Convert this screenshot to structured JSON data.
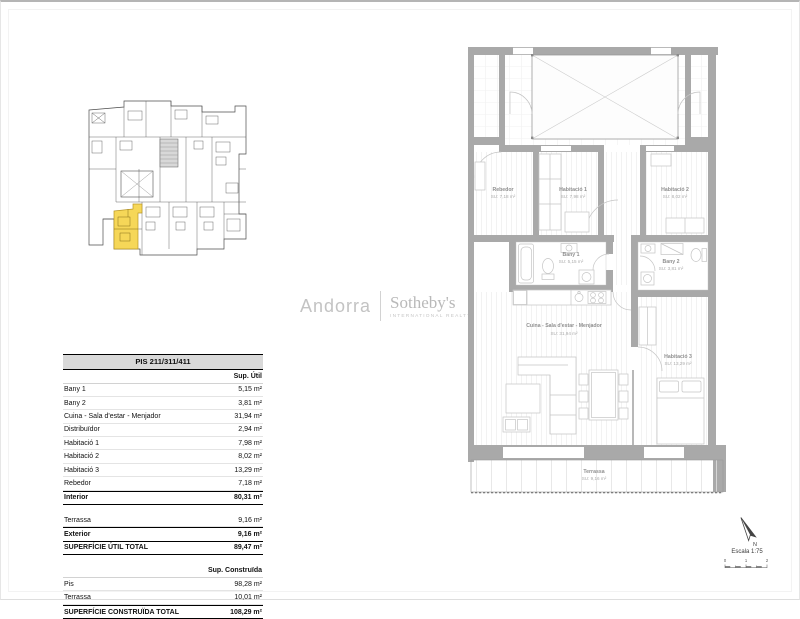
{
  "logo": {
    "left": "Andorra",
    "right": "Sotheby's",
    "tagline": "INTERNATIONAL REALTY"
  },
  "table": {
    "title": "PIS 211/311/411",
    "util_header": "Sup. Útil",
    "rows_util": [
      {
        "label": "Bany 1",
        "value": "5,15 m²"
      },
      {
        "label": "Bany 2",
        "value": "3,81 m²"
      },
      {
        "label": "Cuina - Sala d'estar - Menjador",
        "value": "31,94 m²"
      },
      {
        "label": "Distribuïdor",
        "value": "2,94 m²"
      },
      {
        "label": "Habitació 1",
        "value": "7,98 m²"
      },
      {
        "label": "Habitació 2",
        "value": "8,02 m²"
      },
      {
        "label": "Habitació 3",
        "value": "13,29 m²"
      },
      {
        "label": "Rebedor",
        "value": "7,18 m²"
      }
    ],
    "interior": {
      "label": "Interior",
      "value": "80,31 m²"
    },
    "terrassa_util": {
      "label": "Terrassa",
      "value": "9,16 m²"
    },
    "exterior": {
      "label": "Exterior",
      "value": "9,16 m²"
    },
    "total_util": {
      "label": "SUPERFÍCIE ÚTIL TOTAL",
      "value": "89,47 m²"
    },
    "construida_header": "Sup. Construïda",
    "rows_construida": [
      {
        "label": "Pis",
        "value": "98,28 m²"
      },
      {
        "label": "Terrassa",
        "value": "10,01 m²"
      }
    ],
    "total_construida": {
      "label": "SUPERFÍCIE CONSTRUÏDA TOTAL",
      "value": "108,29 m²"
    }
  },
  "floorplan": {
    "rooms": [
      {
        "name": "Rebedor",
        "area": "SU: 7,18 m²"
      },
      {
        "name": "Habitació 1",
        "area": "SU: 7,98 m²"
      },
      {
        "name": "Habitació 2",
        "area": "SU: 8,02 m²"
      },
      {
        "name": "Bany 1",
        "area": "SU: 5,15 m²"
      },
      {
        "name": "Bany 2",
        "area": "SU: 3,81 m²"
      },
      {
        "name": "Cuina - Sala d'estar - Menjador",
        "area": "SU: 31,94 m²"
      },
      {
        "name": "Habitació 3",
        "area": "SU: 13,29 m²"
      },
      {
        "name": "Terrassa",
        "area": "SU: 9,16 m²"
      }
    ]
  },
  "scale": {
    "north_label": "N",
    "escala": "Escala 1:75",
    "ticks": [
      "0",
      "1",
      "2"
    ]
  },
  "colors": {
    "highlight_yellow": "#F6D54F",
    "wall_gray": "#a9a9a9"
  }
}
